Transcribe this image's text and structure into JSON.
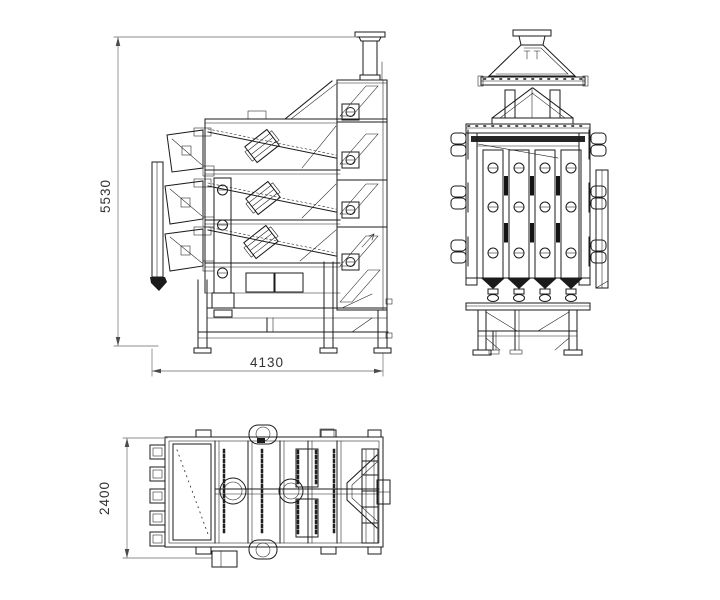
{
  "dimensions": {
    "height_label": "5530",
    "length_label": "4130",
    "width_label": "2400"
  },
  "colors": {
    "line": "#1b1b1b",
    "dimension_line": "#8e8e8e",
    "background": "#ffffff"
  }
}
